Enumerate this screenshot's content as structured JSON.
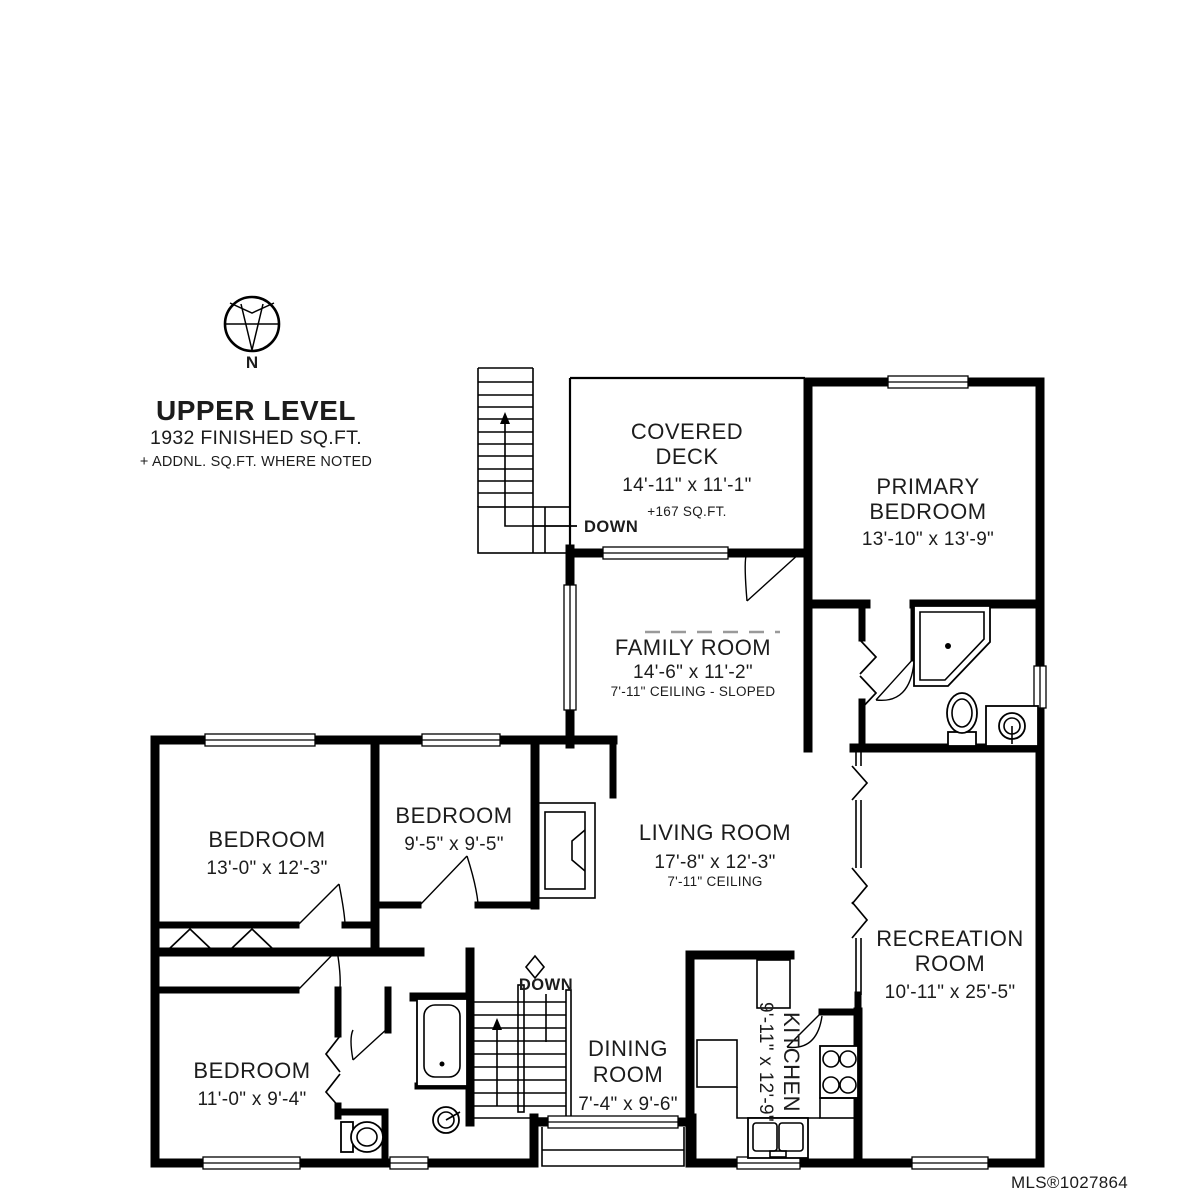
{
  "page": {
    "credit": "MLS®1027864",
    "colors": {
      "walls": "#000000",
      "credit": "#b3b3b3"
    }
  },
  "title_block": {
    "title": "UPPER LEVEL",
    "sqft": "1932 FINISHED SQ.FT.",
    "note": "+ ADDNL. SQ.FT. WHERE NOTED"
  },
  "compass": {
    "label": "N"
  },
  "stairs": {
    "deck_down_label": "DOWN",
    "main_down_label": "DOWN"
  },
  "rooms": {
    "covered_deck": {
      "line1": "COVERED",
      "line2": "DECK",
      "dims": "14'-11\" x 11'-1\"",
      "note": "+167 SQ.FT."
    },
    "primary_bedroom": {
      "line1": "PRIMARY",
      "line2": "BEDROOM",
      "dims": "13'-10\" x 13'-9\""
    },
    "family_room": {
      "line1": "FAMILY ROOM",
      "dims": "14'-6\" x 11'-2\"",
      "note": "7'-11\" CEILING - SLOPED"
    },
    "bedroom_left": {
      "line1": "BEDROOM",
      "dims": "13'-0\" x 12'-3\""
    },
    "bedroom_middle": {
      "line1": "BEDROOM",
      "dims": "9'-5\" x 9'-5\""
    },
    "living_room": {
      "line1": "LIVING ROOM",
      "dims": "17'-8\" x 12'-3\"",
      "note": "7'-11\" CEILING"
    },
    "recreation_room": {
      "line1": "RECREATION",
      "line2": "ROOM",
      "dims": "10'-11\" x 25'-5\""
    },
    "bedroom_lower": {
      "line1": "BEDROOM",
      "dims": "11'-0\" x 9'-4\""
    },
    "dining_room": {
      "line1": "DINING",
      "line2": "ROOM",
      "dims": "7'-4\" x 9'-6\""
    },
    "kitchen": {
      "line1": "KITCHEN",
      "dims": "9'-11\" x 12'-9\""
    }
  }
}
